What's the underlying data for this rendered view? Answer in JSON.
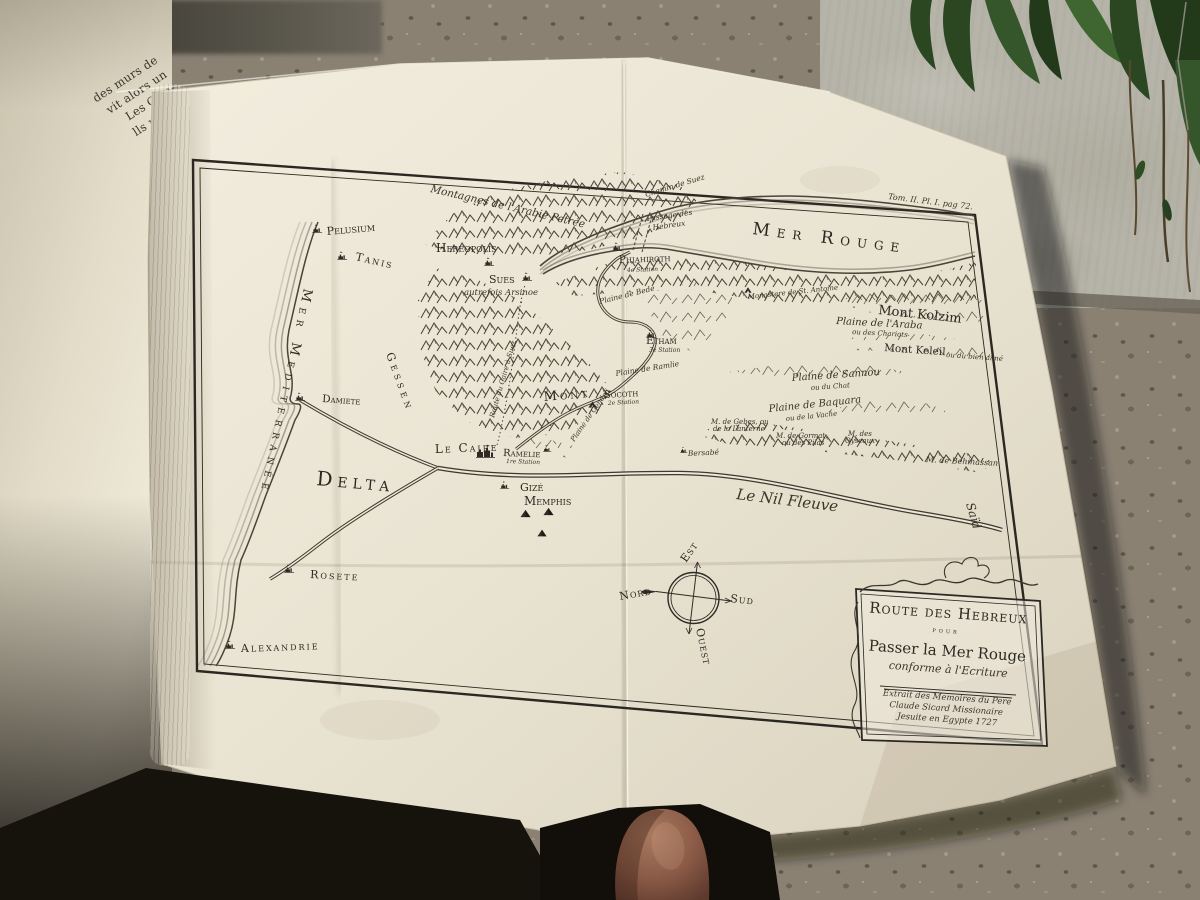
{
  "photo": {
    "book_page": {
      "visible_text_lines": [
        "des murs de",
        "vit alors un",
        "Les Com-",
        "lls remar-",
        "Rouge ,",
        "& c'est",
        "Suph ,",
        "voyoit",
        "iviers.",
        "Golfe ,",
        "ifique",
        "st un",
        "er-",
        "nc",
        "s."
      ]
    },
    "colors": {
      "paper": "#e9e3d2",
      "ink": "#2e2a22",
      "wall": "#b6b3a8",
      "gravel": "#8a8173",
      "plants": "#2b4721",
      "skin": "#8a5a46"
    }
  },
  "map": {
    "labels": [
      {
        "group": "plate",
        "name": "plate-reference",
        "text": "Tom. II. Pl. I. pag 72.",
        "x": 888,
        "y": 199,
        "rot": 7,
        "fs": 8,
        "cls": "it"
      },
      {
        "group": "sea",
        "name": "label-mer-rouge",
        "text": "Mer Rouge",
        "x": 752,
        "y": 234,
        "rot": 7,
        "fs": 17,
        "cls": "sc",
        "ls": 7
      },
      {
        "group": "sea",
        "name": "label-mer-mediterranee",
        "text": "Mer Mediterranée",
        "x": 304,
        "y": 288,
        "rot": 102,
        "fs": 13,
        "cls": "sc",
        "ls": 6
      },
      {
        "group": "sea",
        "name": "label-le-nil-fleuve",
        "text": "Le Nil Fleuve",
        "x": 736,
        "y": 499,
        "rot": 7,
        "fs": 15,
        "cls": "it"
      },
      {
        "group": "region",
        "name": "label-said",
        "text": "Saïd",
        "x": 966,
        "y": 504,
        "rot": 74,
        "fs": 12,
        "cls": "it"
      },
      {
        "group": "region",
        "name": "label-delta",
        "text": "Delta",
        "x": 316,
        "y": 485,
        "rot": 5,
        "fs": 20,
        "cls": "sc",
        "ls": 5
      },
      {
        "group": "region",
        "name": "label-gessen",
        "text": "Gessen",
        "x": 386,
        "y": 354,
        "rot": 70,
        "fs": 11,
        "cls": "sc",
        "ls": 4
      },
      {
        "group": "region",
        "name": "label-montagnes-arabie",
        "text": "Montagnes de l'Arabie Petrée",
        "x": 430,
        "y": 192,
        "rot": 13,
        "fs": 10.5,
        "cls": "it"
      },
      {
        "group": "route",
        "name": "label-chemin-de-suez",
        "text": "Chemin de Suez",
        "x": 646,
        "y": 197,
        "rot": -17,
        "fs": 7.5,
        "cls": "it"
      },
      {
        "group": "route",
        "name": "label-passage-des",
        "text": "Passage des",
        "x": 647,
        "y": 221,
        "rot": -8,
        "fs": 7.5,
        "cls": "it"
      },
      {
        "group": "route",
        "name": "label-passage-hebreux",
        "text": "Hebreux",
        "x": 653,
        "y": 230,
        "rot": -8,
        "fs": 7.5,
        "cls": "it"
      },
      {
        "group": "route",
        "name": "label-route-caire-suez",
        "text": "Route du Caire à Suez",
        "x": 494,
        "y": 418,
        "rot": -74,
        "fs": 7,
        "cls": "it"
      },
      {
        "group": "place",
        "name": "label-pelusium",
        "text": "Pelusium",
        "x": 327,
        "y": 235,
        "rot": -5,
        "fs": 11,
        "cls": "sc"
      },
      {
        "group": "place",
        "name": "label-tanis",
        "text": "Tanis",
        "x": 355,
        "y": 260,
        "rot": 13,
        "fs": 11,
        "cls": "sc",
        "ls": 2
      },
      {
        "group": "place",
        "name": "label-hereopolis",
        "text": "Hereopolis",
        "x": 436,
        "y": 252,
        "fs": 12,
        "cls": "sc"
      },
      {
        "group": "place",
        "name": "label-sues",
        "text": "Sues",
        "x": 489,
        "y": 283,
        "fs": 11,
        "cls": "sc"
      },
      {
        "group": "place",
        "name": "label-arsinoe",
        "text": "autrefois Arsinoe",
        "x": 464,
        "y": 295,
        "fs": 8.5,
        "cls": "it"
      },
      {
        "group": "place",
        "name": "label-phiahiroth",
        "text": "Phiahiroth",
        "x": 619,
        "y": 263,
        "rot": -2,
        "fs": 10.5,
        "cls": "sc"
      },
      {
        "group": "place",
        "name": "label-phiahiroth-station",
        "text": "4e Station",
        "x": 627,
        "y": 272,
        "rot": -2,
        "fs": 6,
        "cls": "it"
      },
      {
        "group": "place",
        "name": "label-plaine-bede",
        "text": "Plaine de Bede",
        "x": 600,
        "y": 304,
        "rot": -14,
        "fs": 7.5,
        "cls": "it"
      },
      {
        "group": "place",
        "name": "label-plaine-ramlie",
        "text": "Plaine de Ramlie",
        "x": 616,
        "y": 376,
        "rot": -9,
        "fs": 7.5,
        "cls": "it"
      },
      {
        "group": "place",
        "name": "label-etham",
        "text": "Etham",
        "x": 646,
        "y": 344,
        "fs": 10.5,
        "cls": "sc"
      },
      {
        "group": "place",
        "name": "label-etham-station",
        "text": "3e Station",
        "x": 649,
        "y": 352,
        "fs": 6,
        "cls": "it"
      },
      {
        "group": "place",
        "name": "label-monastere",
        "text": "Monastere de St. Antoine",
        "x": 748,
        "y": 299,
        "rot": -6,
        "fs": 7,
        "cls": "it"
      },
      {
        "group": "place",
        "name": "label-mont-kolzim",
        "text": "Mont Kolzim",
        "x": 878,
        "y": 314,
        "rot": 6,
        "fs": 13,
        "cls": "rm"
      },
      {
        "group": "place",
        "name": "label-plaine-araba",
        "text": "Plaine de l'Araba",
        "x": 836,
        "y": 324,
        "rot": 3,
        "fs": 10,
        "cls": "it"
      },
      {
        "group": "place",
        "name": "label-araba-sub",
        "text": "ou des Chariots",
        "x": 852,
        "y": 334,
        "rot": 3,
        "fs": 7,
        "cls": "it"
      },
      {
        "group": "place",
        "name": "label-mont-keleil",
        "text": "Mont Keleil",
        "x": 884,
        "y": 351,
        "rot": 4,
        "fs": 10.5,
        "cls": "rm"
      },
      {
        "group": "place",
        "name": "label-keleil-sub",
        "text": "ou du bien aimé",
        "x": 946,
        "y": 357,
        "rot": 4,
        "fs": 7,
        "cls": "it"
      },
      {
        "group": "place",
        "name": "label-plaine-sannou",
        "text": "Plaine de Sannou",
        "x": 792,
        "y": 381,
        "rot": -4,
        "fs": 10,
        "cls": "it"
      },
      {
        "group": "place",
        "name": "label-sannou-sub",
        "text": "ou du Chat",
        "x": 811,
        "y": 390,
        "rot": -4,
        "fs": 7,
        "cls": "it"
      },
      {
        "group": "place",
        "name": "label-plaine-baquara",
        "text": "Plaine de Baquara",
        "x": 769,
        "y": 412,
        "rot": -6,
        "fs": 10,
        "cls": "it"
      },
      {
        "group": "place",
        "name": "label-baquara-sub",
        "text": "ou de la Vache",
        "x": 786,
        "y": 421,
        "rot": -6,
        "fs": 7,
        "cls": "it"
      },
      {
        "group": "place",
        "name": "label-gebes-1",
        "text": "M. de Gebes, ou",
        "x": 711,
        "y": 424,
        "fs": 7,
        "cls": "it"
      },
      {
        "group": "place",
        "name": "label-gebes-2",
        "text": "de la Lanterne",
        "x": 713,
        "y": 431,
        "fs": 7,
        "cls": "it"
      },
      {
        "group": "place",
        "name": "label-gormat-1",
        "text": "M. de Gormat,",
        "x": 776,
        "y": 438,
        "fs": 7,
        "cls": "it"
      },
      {
        "group": "place",
        "name": "label-gormat-2",
        "text": "ou des Pilas",
        "x": 782,
        "y": 445,
        "fs": 7,
        "cls": "it"
      },
      {
        "group": "place",
        "name": "label-oyseaux-1",
        "text": "M. des",
        "x": 848,
        "y": 436,
        "fs": 7,
        "cls": "it"
      },
      {
        "group": "place",
        "name": "label-oyseaux-2",
        "text": "Oyseaux",
        "x": 845,
        "y": 443,
        "fs": 7,
        "cls": "it"
      },
      {
        "group": "place",
        "name": "label-behihassan",
        "text": "M. de Behihassan",
        "x": 926,
        "y": 462,
        "rot": 3,
        "fs": 8,
        "cls": "it"
      },
      {
        "group": "place",
        "name": "label-bersabe",
        "text": "Bersabé",
        "x": 688,
        "y": 456,
        "rot": -3,
        "fs": 7.5,
        "cls": "it"
      },
      {
        "group": "place",
        "name": "label-mont",
        "text": "Mont",
        "x": 544,
        "y": 401,
        "rot": -5,
        "fs": 13,
        "cls": "sc",
        "ls": 3
      },
      {
        "group": "place",
        "name": "label-socoth",
        "text": "Socoth",
        "x": 604,
        "y": 398,
        "rot": -3,
        "fs": 10,
        "cls": "sc"
      },
      {
        "group": "place",
        "name": "label-socoth-station",
        "text": "2e Station",
        "x": 608,
        "y": 405,
        "rot": -3,
        "fs": 6,
        "cls": "it"
      },
      {
        "group": "place",
        "name": "label-plaine-gendeli",
        "text": "Plaine de Gendeli",
        "x": 574,
        "y": 442,
        "rot": -55,
        "fs": 7,
        "cls": "it"
      },
      {
        "group": "place",
        "name": "label-le-caire",
        "text": "Le Caire",
        "x": 435,
        "y": 453,
        "rot": -2,
        "fs": 12,
        "cls": "sc",
        "ls": 2
      },
      {
        "group": "place",
        "name": "label-ramelie",
        "text": "Ramelie",
        "x": 503,
        "y": 456,
        "rot": 2,
        "fs": 10,
        "cls": "sc"
      },
      {
        "group": "place",
        "name": "label-ramelie-station",
        "text": "1re Station",
        "x": 506,
        "y": 463,
        "rot": 2,
        "fs": 6,
        "cls": "it"
      },
      {
        "group": "place",
        "name": "label-gize",
        "text": "Gizé",
        "x": 520,
        "y": 491,
        "fs": 11,
        "cls": "sc"
      },
      {
        "group": "place",
        "name": "label-memphis",
        "text": "Memphis",
        "x": 524,
        "y": 505,
        "fs": 12,
        "cls": "sc"
      },
      {
        "group": "place",
        "name": "label-damiete",
        "text": "Damiete",
        "x": 322,
        "y": 402,
        "rot": 4,
        "fs": 10.5,
        "cls": "sc"
      },
      {
        "group": "place",
        "name": "label-rosete",
        "text": "Rosete",
        "x": 310,
        "y": 578,
        "rot": 3,
        "fs": 11,
        "cls": "sc",
        "ls": 2
      },
      {
        "group": "place",
        "name": "label-alexandrie",
        "text": "Alexandrie",
        "x": 241,
        "y": 652,
        "rot": -2,
        "fs": 11,
        "cls": "sc",
        "ls": 2
      },
      {
        "group": "compass",
        "name": "compass-nord-label",
        "text": "Nord",
        "x": 620,
        "y": 600,
        "rot": -10,
        "fs": 11,
        "cls": "sc",
        "ls": 1
      },
      {
        "group": "compass",
        "name": "compass-est-label",
        "text": "Est",
        "x": 686,
        "y": 563,
        "rot": -55,
        "fs": 11,
        "cls": "sc",
        "ls": 1
      },
      {
        "group": "compass",
        "name": "compass-sud-label",
        "text": "Sud",
        "x": 730,
        "y": 602,
        "rot": 6,
        "fs": 11,
        "cls": "sc",
        "ls": 1
      },
      {
        "group": "compass",
        "name": "compass-ouest-label",
        "text": "Ouest",
        "x": 696,
        "y": 629,
        "rot": 78,
        "fs": 11,
        "cls": "sc",
        "ls": 1
      },
      {
        "group": "cartouche",
        "name": "cartouche-title-line1",
        "text": "Route des Hebreux",
        "x": 948,
        "y": 618,
        "rot": 4,
        "fs": 15,
        "cls": "sc",
        "anchor": "middle",
        "ls": 1
      },
      {
        "group": "cartouche",
        "name": "cartouche-title-line2",
        "text": "pour",
        "x": 946,
        "y": 633,
        "rot": 4,
        "fs": 7.5,
        "cls": "sc",
        "anchor": "middle",
        "ls": 3
      },
      {
        "group": "cartouche",
        "name": "cartouche-title-line3",
        "text": "Passer la Mer Rouge",
        "x": 947,
        "y": 656,
        "rot": 4,
        "fs": 15,
        "cls": "rm",
        "anchor": "middle"
      },
      {
        "group": "cartouche",
        "name": "cartouche-title-line4",
        "text": "conforme à l'Ecriture",
        "x": 948,
        "y": 673,
        "rot": 4,
        "fs": 11,
        "cls": "it",
        "anchor": "middle"
      },
      {
        "group": "cartouche",
        "name": "cartouche-attribution-1",
        "text": "Extrait des Memoires du Pere",
        "x": 947,
        "y": 700,
        "rot": 4,
        "fs": 8.5,
        "cls": "it",
        "anchor": "middle"
      },
      {
        "group": "cartouche",
        "name": "cartouche-attribution-2",
        "text": "Claude Sicard Missionaire",
        "x": 946,
        "y": 711,
        "rot": 4,
        "fs": 8.5,
        "cls": "it",
        "anchor": "middle"
      },
      {
        "group": "cartouche",
        "name": "cartouche-attribution-3",
        "text": "Jesuite en Egypte 1727",
        "x": 947,
        "y": 722,
        "rot": 4,
        "fs": 8.5,
        "cls": "it",
        "anchor": "middle"
      }
    ],
    "icons": [
      {
        "type": "city",
        "x": 312,
        "y": 222,
        "name": "pelusium-icon"
      },
      {
        "type": "city",
        "x": 337,
        "y": 249,
        "name": "tanis-icon"
      },
      {
        "type": "city",
        "x": 484,
        "y": 255,
        "name": "hereopolis-icon"
      },
      {
        "type": "city",
        "x": 522,
        "y": 270,
        "name": "sues-icon"
      },
      {
        "type": "city",
        "x": 612,
        "y": 240,
        "name": "phiahiroth-icon"
      },
      {
        "type": "city",
        "x": 646,
        "y": 327,
        "name": "etham-icon"
      },
      {
        "type": "tent",
        "x": 588,
        "y": 400,
        "s": 9,
        "name": "socoth-icon"
      },
      {
        "type": "bigcity",
        "x": 476,
        "y": 441,
        "s": 20,
        "name": "caire-icon"
      },
      {
        "type": "city",
        "x": 543,
        "y": 443,
        "s": 9,
        "name": "ramelie-icon"
      },
      {
        "type": "city",
        "x": 295,
        "y": 390,
        "name": "damiete-icon"
      },
      {
        "type": "city",
        "x": 284,
        "y": 562,
        "name": "rosete-icon"
      },
      {
        "type": "city",
        "x": 225,
        "y": 638,
        "name": "alexandrie-icon"
      },
      {
        "type": "city",
        "x": 500,
        "y": 479,
        "s": 10,
        "name": "gize-icon"
      },
      {
        "type": "pyramid",
        "x": 520,
        "y": 508,
        "name": "pyramid-icon"
      },
      {
        "type": "pyramid",
        "x": 543,
        "y": 506,
        "name": "pyramid-icon"
      },
      {
        "type": "pyramid",
        "x": 537,
        "y": 528,
        "s": 10,
        "name": "pyramid-icon"
      },
      {
        "type": "city",
        "x": 680,
        "y": 445,
        "s": 8,
        "name": "bersabe-icon"
      },
      {
        "type": "tent",
        "x": 744,
        "y": 286,
        "s": 8,
        "name": "monastere-icon"
      }
    ]
  }
}
